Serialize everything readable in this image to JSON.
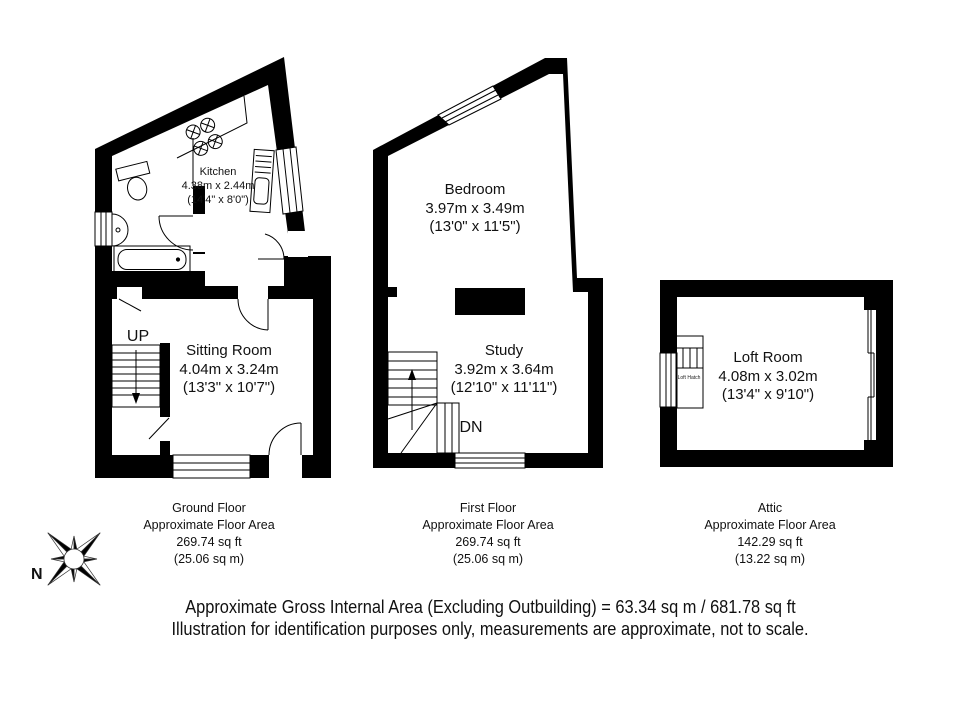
{
  "plans": {
    "ground": {
      "kitchen_name": "Kitchen",
      "kitchen_dims_m": "4.38m x 2.44m",
      "kitchen_dims_ft": "(14'4\" x 8'0\")",
      "sitting_name": "Sitting Room",
      "sitting_dims_m": "4.04m x 3.24m",
      "sitting_dims_ft": "(13'3\" x 10'7\")",
      "stair_label": "UP",
      "caption_title": "Ground Floor",
      "caption_sub": "Approximate Floor Area",
      "caption_ft": "269.74 sq ft",
      "caption_m": "(25.06 sq m)"
    },
    "first": {
      "bedroom_name": "Bedroom",
      "bedroom_dims_m": "3.97m x 3.49m",
      "bedroom_dims_ft": "(13'0\" x 11'5\")",
      "study_name": "Study",
      "study_dims_m": "3.92m x 3.64m",
      "study_dims_ft": "(12'10\" x 11'11\")",
      "stair_label": "DN",
      "caption_title": "First Floor",
      "caption_sub": "Approximate Floor Area",
      "caption_ft": "269.74 sq ft",
      "caption_m": "(25.06 sq m)"
    },
    "attic": {
      "loft_name": "Loft Room",
      "loft_dims_m": "4.08m x 3.02m",
      "loft_dims_ft": "(13'4\" x 9'10\")",
      "hatch_label": "Loft Hatch",
      "caption_title": "Attic",
      "caption_sub": "Approximate Floor Area",
      "caption_ft": "142.29 sq ft",
      "caption_m": "(13.22 sq m)"
    }
  },
  "compass": {
    "north_label": "N"
  },
  "footer": {
    "line1": "Approximate Gross Internal Area (Excluding Outbuilding) = 63.34 sq m / 681.78 sq ft",
    "line2": "Illustration for identification purposes only, measurements are approximate, not to scale."
  },
  "colors": {
    "wall": "#000000",
    "background": "#ffffff"
  }
}
